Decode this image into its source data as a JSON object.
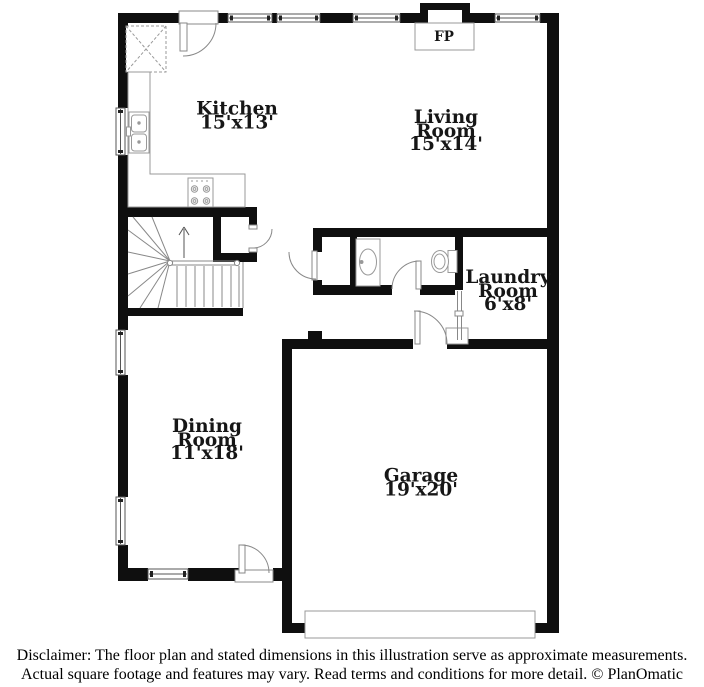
{
  "plan_type": "floor-plan",
  "rooms": {
    "kitchen": {
      "name": "Kitchen",
      "dims": "15'x13'"
    },
    "living": {
      "name_line1": "Living",
      "name_line2": "Room",
      "dims": "15'x14'"
    },
    "laundry": {
      "name_line1": "Laundry",
      "name_line2": "Room",
      "dims": "6'x8'"
    },
    "dining": {
      "name_line1": "Dining",
      "name_line2": "Room",
      "dims": "11'x18'"
    },
    "garage": {
      "name": "Garage",
      "dims": "19'x20'"
    }
  },
  "fireplace": {
    "label": "FP"
  },
  "disclaimer": {
    "line1": "Disclaimer: The floor plan and stated dimensions in this illustration serve as approximate measurements.",
    "line2": "Actual square footage and features may vary. Read terms and conditions for more detail. © PlanOmatic"
  },
  "colors": {
    "background": "#ffffff",
    "wall": "#0f0f0f",
    "fixture_line": "#999999",
    "window_frame": "#555555",
    "text": "#161616"
  }
}
